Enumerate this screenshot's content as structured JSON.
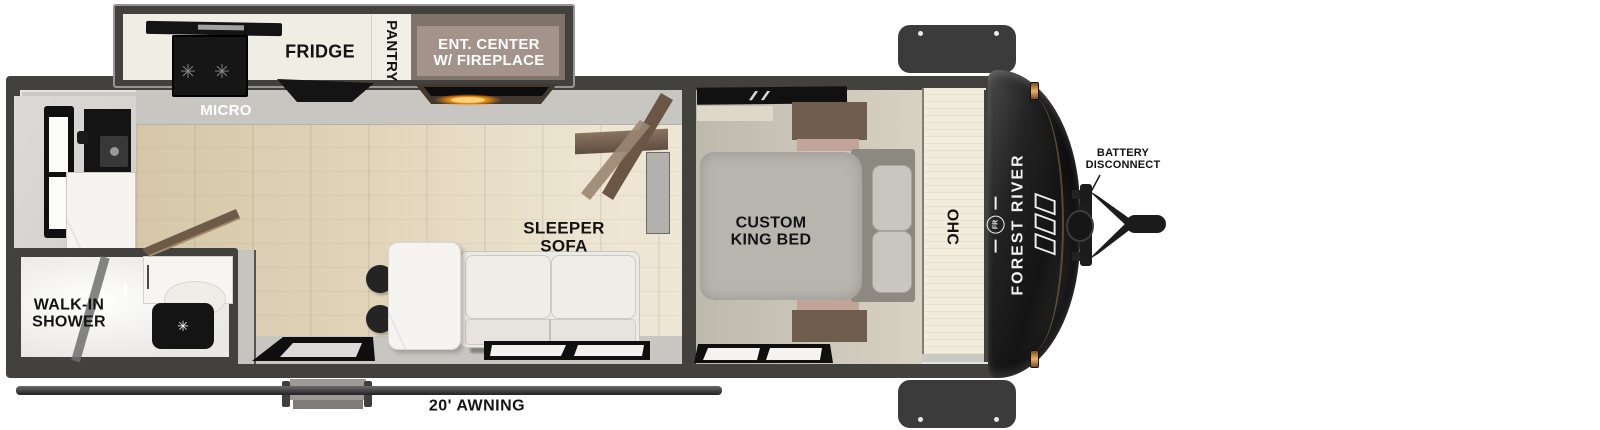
{
  "labels": {
    "micro": "MICRO",
    "fridge": "FRIDGE",
    "pantry": "PANTRY",
    "ent_center_line1": "ENT. CENTER",
    "ent_center_line2": "W/ FIREPLACE",
    "sleeper_line1": "SLEEPER",
    "sleeper_line2": "SOFA",
    "king_line1": "CUSTOM",
    "king_line2": "KING BED",
    "shower_line1": "WALK-IN",
    "shower_line2": "SHOWER",
    "ohc": "OHC",
    "awning": "20' AWNING",
    "battery_line1": "BATTERY",
    "battery_line2": "DISCONNECT",
    "brand": "FOREST RIVER",
    "brand_monogram": "FR"
  },
  "icons": {
    "burner": "✳",
    "flush": "✳"
  },
  "palette": {
    "wall": "#43413e",
    "wallLight": "#cbc9c4",
    "cream": "#f0ede4",
    "taupe": "#a3938a",
    "floorGrey": "#c8c6c1",
    "bedroomFloor": "#c5c1b5",
    "mattress": "#b8b5af",
    "pillow": "#c9c6c0",
    "headboard": "#8c8981",
    "nightstand": "#6f5d4e",
    "nightstandAccent": "#c3a499",
    "sofa": "#eceae4",
    "marble": "#f5f4f1",
    "applianceBlack": "#141414",
    "doorBrown": "#6e5a49",
    "doorTan": "#9a8671",
    "ohcPanel": "#f2ecdc",
    "capDark": "#1a1a1a",
    "amber": "#e8a33d",
    "fireGlow": "#f09a1a",
    "labelInk": "#131313",
    "labelWhite": "#ffffff"
  }
}
